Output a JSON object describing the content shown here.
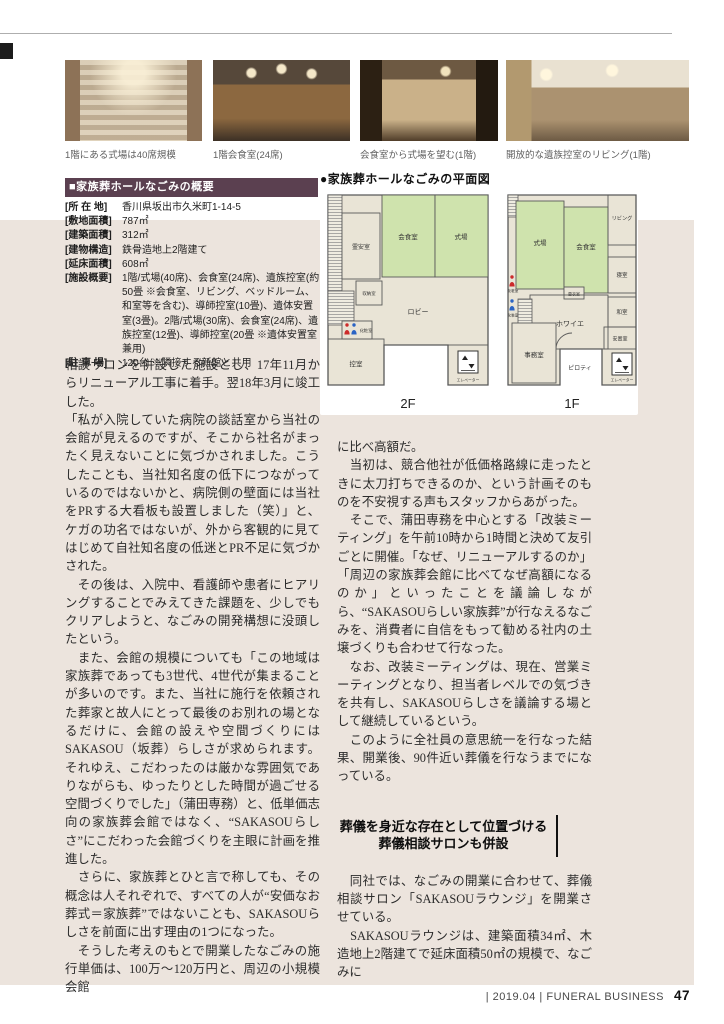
{
  "photos": [
    {
      "caption": "1階にある式場は40席規模"
    },
    {
      "caption": "1階会食室(24席)"
    },
    {
      "caption": "会食室から式場を望む(1階)"
    },
    {
      "caption": "開放的な遺族控室のリビング(1階)"
    }
  ],
  "overview": {
    "title": "■家族葬ホールなごみの概要",
    "rows": [
      {
        "label": "[所 在 地]",
        "value": "香川県坂出市久米町1-14-5"
      },
      {
        "label": "[敷地面積]",
        "value": "787㎡"
      },
      {
        "label": "[建築面積]",
        "value": "312㎡"
      },
      {
        "label": "[建物構造]",
        "value": "鉄骨造地上2階建て"
      },
      {
        "label": "[延床面積]",
        "value": "608㎡"
      },
      {
        "label": "[施設概要]",
        "value": "1階/式場(40席)、会食室(24席)、遺族控室(約50畳 ※会食室、リビング、ベッドルーム、和室等を含む)、導師控室(10畳)、遺体安置室(3畳)。2階/式場(30席)、会食室(24席)、遺族控室(12畳)、導師控室(20畳 ※遺体安置室兼用)"
      },
      {
        "label": "[駐 車 場]",
        "value": "120台 ※隣接する新館と共用"
      }
    ]
  },
  "floorplan": {
    "title": "●家族葬ホールなごみの平面図",
    "f2": {
      "label": "2F",
      "rooms": {
        "reian": "霊安室",
        "kaishoku": "会食室",
        "shikijo": "式場",
        "shunou": "収納室",
        "lobby": "ロビー",
        "keshou": "化粧室",
        "hikae": "控室",
        "elevator": "エレベーター"
      }
    },
    "f1": {
      "label": "1F",
      "rooms": {
        "shikijo": "式場",
        "kaishoku": "会食室",
        "living": "リビング",
        "shinshitsu": "寝室",
        "kouishitsu": "更衣室",
        "foyer": "ホワイエ",
        "washitsu": "和室",
        "anchishitsu": "安置室",
        "keshou": "化粧室",
        "jimushitsu": "事務室",
        "piloti": "ピロティ",
        "elevator": "エレベーター"
      }
    }
  },
  "article": {
    "left_paragraphs": [
      "相談サロンを併設した施設とし、17年11月からリニューアル工事に着手。翌18年3月に竣工した。",
      "「私が入院していた病院の談話室から当社の会館が見えるのですが、そこから社名がまったく見えないことに気づかされました。こうしたことも、当社知名度の低下につながっているのではないかと、病院側の壁面には当社をPRする大看板も設置しました（笑）」と、ケガの功名ではないが、外から客観的に見てはじめて自社知名度の低迷とPR不足に気づかされた。",
      "　その後は、入院中、看護師や患者にヒアリングすることでみえてきた課題を、少しでもクリアしようと、なごみの開発構想に没頭したという。",
      "　また、会館の規模についても「この地域は家族葬であっても3世代、4世代が集まることが多いのです。また、当社に施行を依頼された葬家と故人にとって最後のお別れの場となるだけに、会館の設えや空間づくりにはSAKASOU（坂葬）らしさが求められます。それゆえ、こだわったのは厳かな雰囲気でありながらも、ゆったりとした時間が過ごせる空間づくりでした」（蒲田専務）と、低単価志向の家族葬会館ではなく、“SAKASOUらしさ”にこだわった会館づくりを主眼に計画を推進した。",
      "　さらに、家族葬とひと言で称しても、その概念は人それぞれで、すべての人が“安価なお葬式＝家族葬”ではないことも、SAKASOUらしさを前面に出す理由の1つになった。",
      "　そうした考えのもとで開業したなごみの施行単価は、100万〜120万円と、周辺の小規模会館"
    ],
    "right_paragraphs_before": [
      "に比べ高額だ。",
      "　当初は、競合他社が低価格路線に走ったときに太刀打ちできるのか、という計画そのものを不安視する声もスタッフからあがった。",
      "　そこで、蒲田専務を中心とする「改装ミーティング」を午前10時から1時間と決めて友引ごとに開催。「なぜ、リニューアルするのか」「周辺の家族葬会館に比べてなぜ高額になるのか」といったことを議論しながら、“SAKASOUらしい家族葬”が行なえるなごみを、消費者に自信をもって勧める社内の土壌づくりも合わせて行なった。",
      "　なお、改装ミーティングは、現在、営業ミーティングとなり、担当者レベルでの気づきを共有し、SAKASOUらしさを議論する場として継続しているという。",
      "　このように全社員の意思統一を行なった結果、開業後、90件近い葬儀を行なうまでになっている。"
    ],
    "heading": {
      "line1": "葬儀を身近な存在として位置づける",
      "line2": "葬儀相談サロンも併設"
    },
    "right_paragraphs_after": [
      "　同社では、なごみの開業に合わせて、葬儀相談サロン「SAKASOUラウンジ」を開業させている。",
      "　SAKASOUラウンジは、建築面積34㎡、木造地上2階建てで延床面積50㎡の規模で、なごみに"
    ]
  },
  "footer": {
    "text": "| 2019.04 | FUNERAL BUSINESS",
    "page_number": "47"
  },
  "colors": {
    "overview_header_bg": "#5b4050",
    "page_band_bg": "#ece4dd",
    "plan_room_green": "#cfe3ad"
  }
}
